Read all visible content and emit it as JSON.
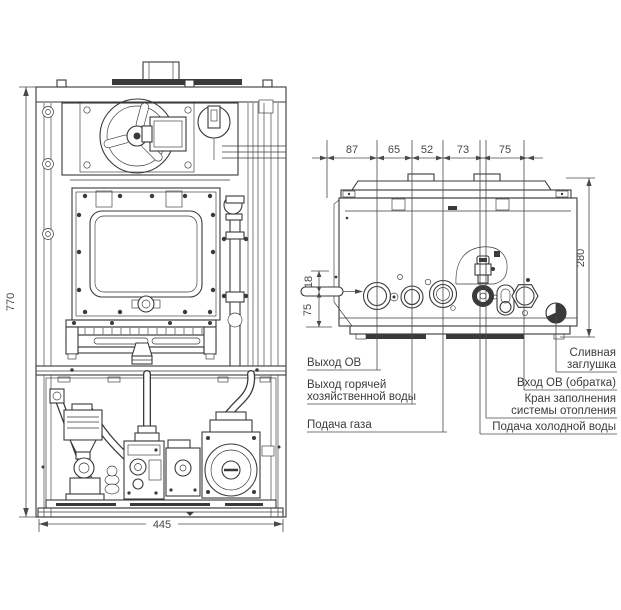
{
  "front_view": {
    "dim_height": "770",
    "dim_width": "445"
  },
  "bottom_view": {
    "dims_top": [
      "87",
      "65",
      "52",
      "73",
      "75"
    ],
    "dim_right": "280",
    "dim_offset_top": "18",
    "dim_offset_bottom": "75",
    "labels": {
      "ch_flow": "Выход ОВ",
      "dhw_line1": "Выход горячей",
      "dhw_line2": "хозяйственной воды",
      "gas": "Подача газа",
      "drain_line1": "Сливная",
      "drain_line2": "заглушка",
      "ch_return": "Вход ОВ (обратка)",
      "fill_line1": "Кран заполнения",
      "fill_line2": "системы отопления",
      "cold_water": "Подача холодной воды"
    }
  },
  "colors": {
    "line": "#3a3a3a",
    "text": "#3c3c3c"
  }
}
